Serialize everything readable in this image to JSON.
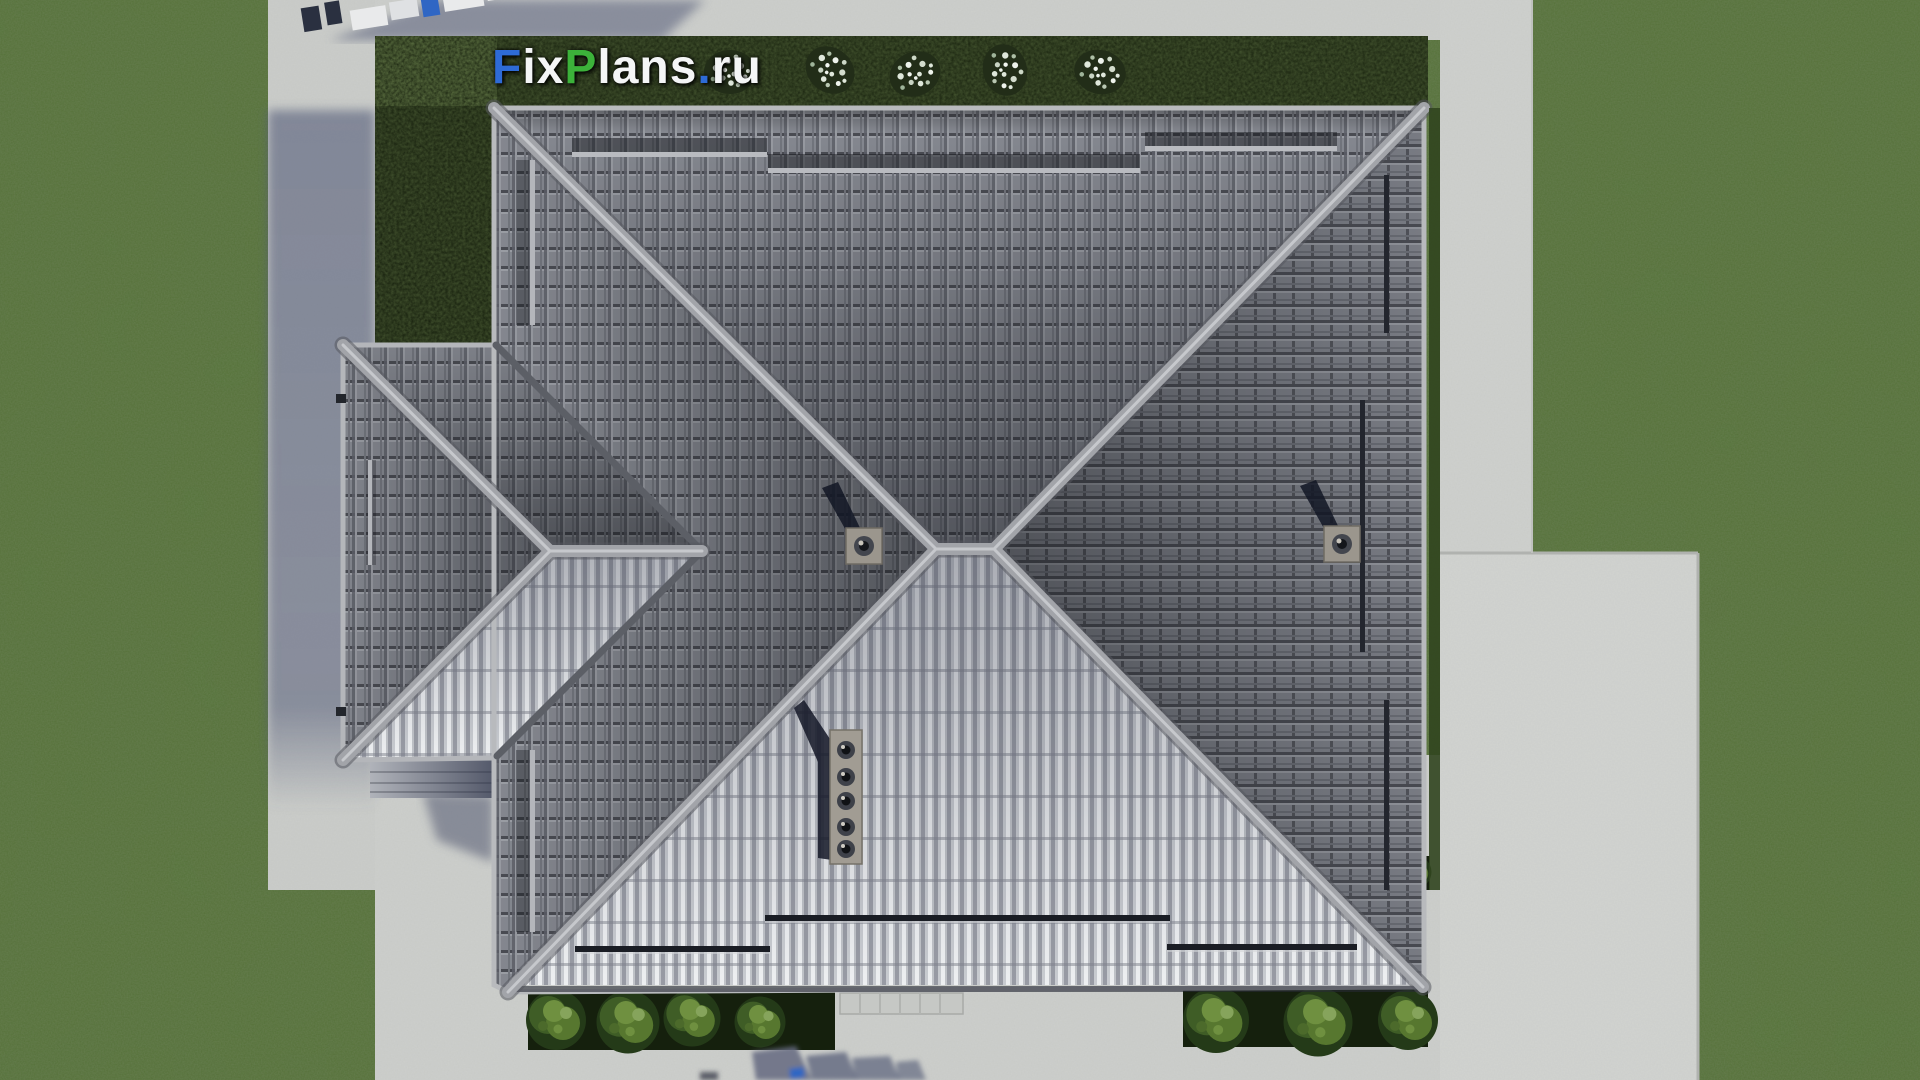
{
  "watermark": {
    "full_text": "FixPlans.ru",
    "segments": [
      {
        "text": "F",
        "color": "#2e6bd6"
      },
      {
        "text": "ix",
        "color": "#f4f5f6"
      },
      {
        "text": "P",
        "color": "#3cb23a"
      },
      {
        "text": "lans",
        "color": "#f4f5f6"
      },
      {
        "text": ".",
        "color": "#2e6bd6"
      },
      {
        "text": "ru",
        "color": "#f4f5f6"
      }
    ]
  },
  "palette": {
    "grass": "#56763a",
    "grass_dark_patch": "#41602c",
    "pavement": "#cdcfcc",
    "pavement_shadow": "#8a90a6",
    "hedge": "#19230f",
    "flower_white": "#e6ecdf",
    "roof_tile_dark": "#85888f",
    "roof_tile_bright": "#e9ebee",
    "ridge_cap": "#a6a8ad",
    "valley": "#5c5f66",
    "vent_plate": "#9b968d",
    "vent_shadow": "#121624",
    "bush_green": "#57772f",
    "logo_blue": "#2e6bd6",
    "logo_green": "#3cb23a",
    "logo_white": "#f4f5f6"
  }
}
